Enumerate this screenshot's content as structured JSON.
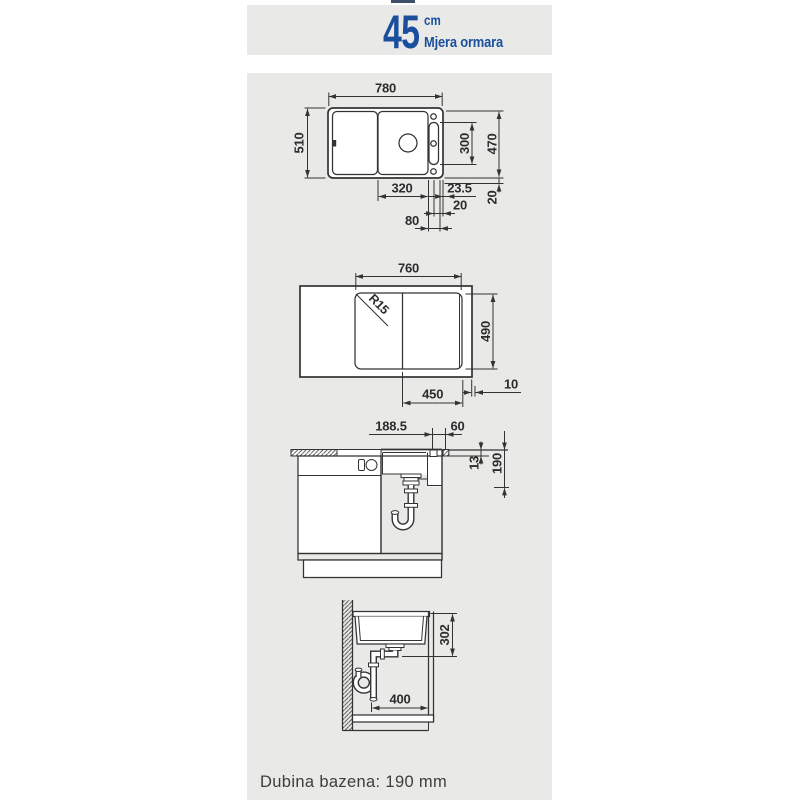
{
  "header": {
    "size_value": "45",
    "size_unit": "cm",
    "size_label": "Mjera ormara"
  },
  "dims": {
    "top_view": {
      "width": "780",
      "height": "510",
      "tap_rail": "300",
      "cutout_depth": "470",
      "bowl_width": "320",
      "edge_offset": "23.5",
      "side_gap": "20",
      "rear_gap": "20",
      "rail_width": "80"
    },
    "cutout_view": {
      "width": "760",
      "corner_radius": "R15",
      "height": "490",
      "bowl_width": "450",
      "edge_gap": "10"
    },
    "side_section": {
      "drain_offset": "188.5",
      "tap_offset": "60",
      "rim_height": "13",
      "bowl_depth": "190"
    },
    "front_section": {
      "drain_height": "302",
      "clearance_width": "400"
    }
  },
  "footer": {
    "note": "Dubina bazena: 190 mm"
  },
  "colors": {
    "accent_blue": "#1a4f9e",
    "panel_gray": "#e9e9e7",
    "line_dark": "#333333"
  }
}
